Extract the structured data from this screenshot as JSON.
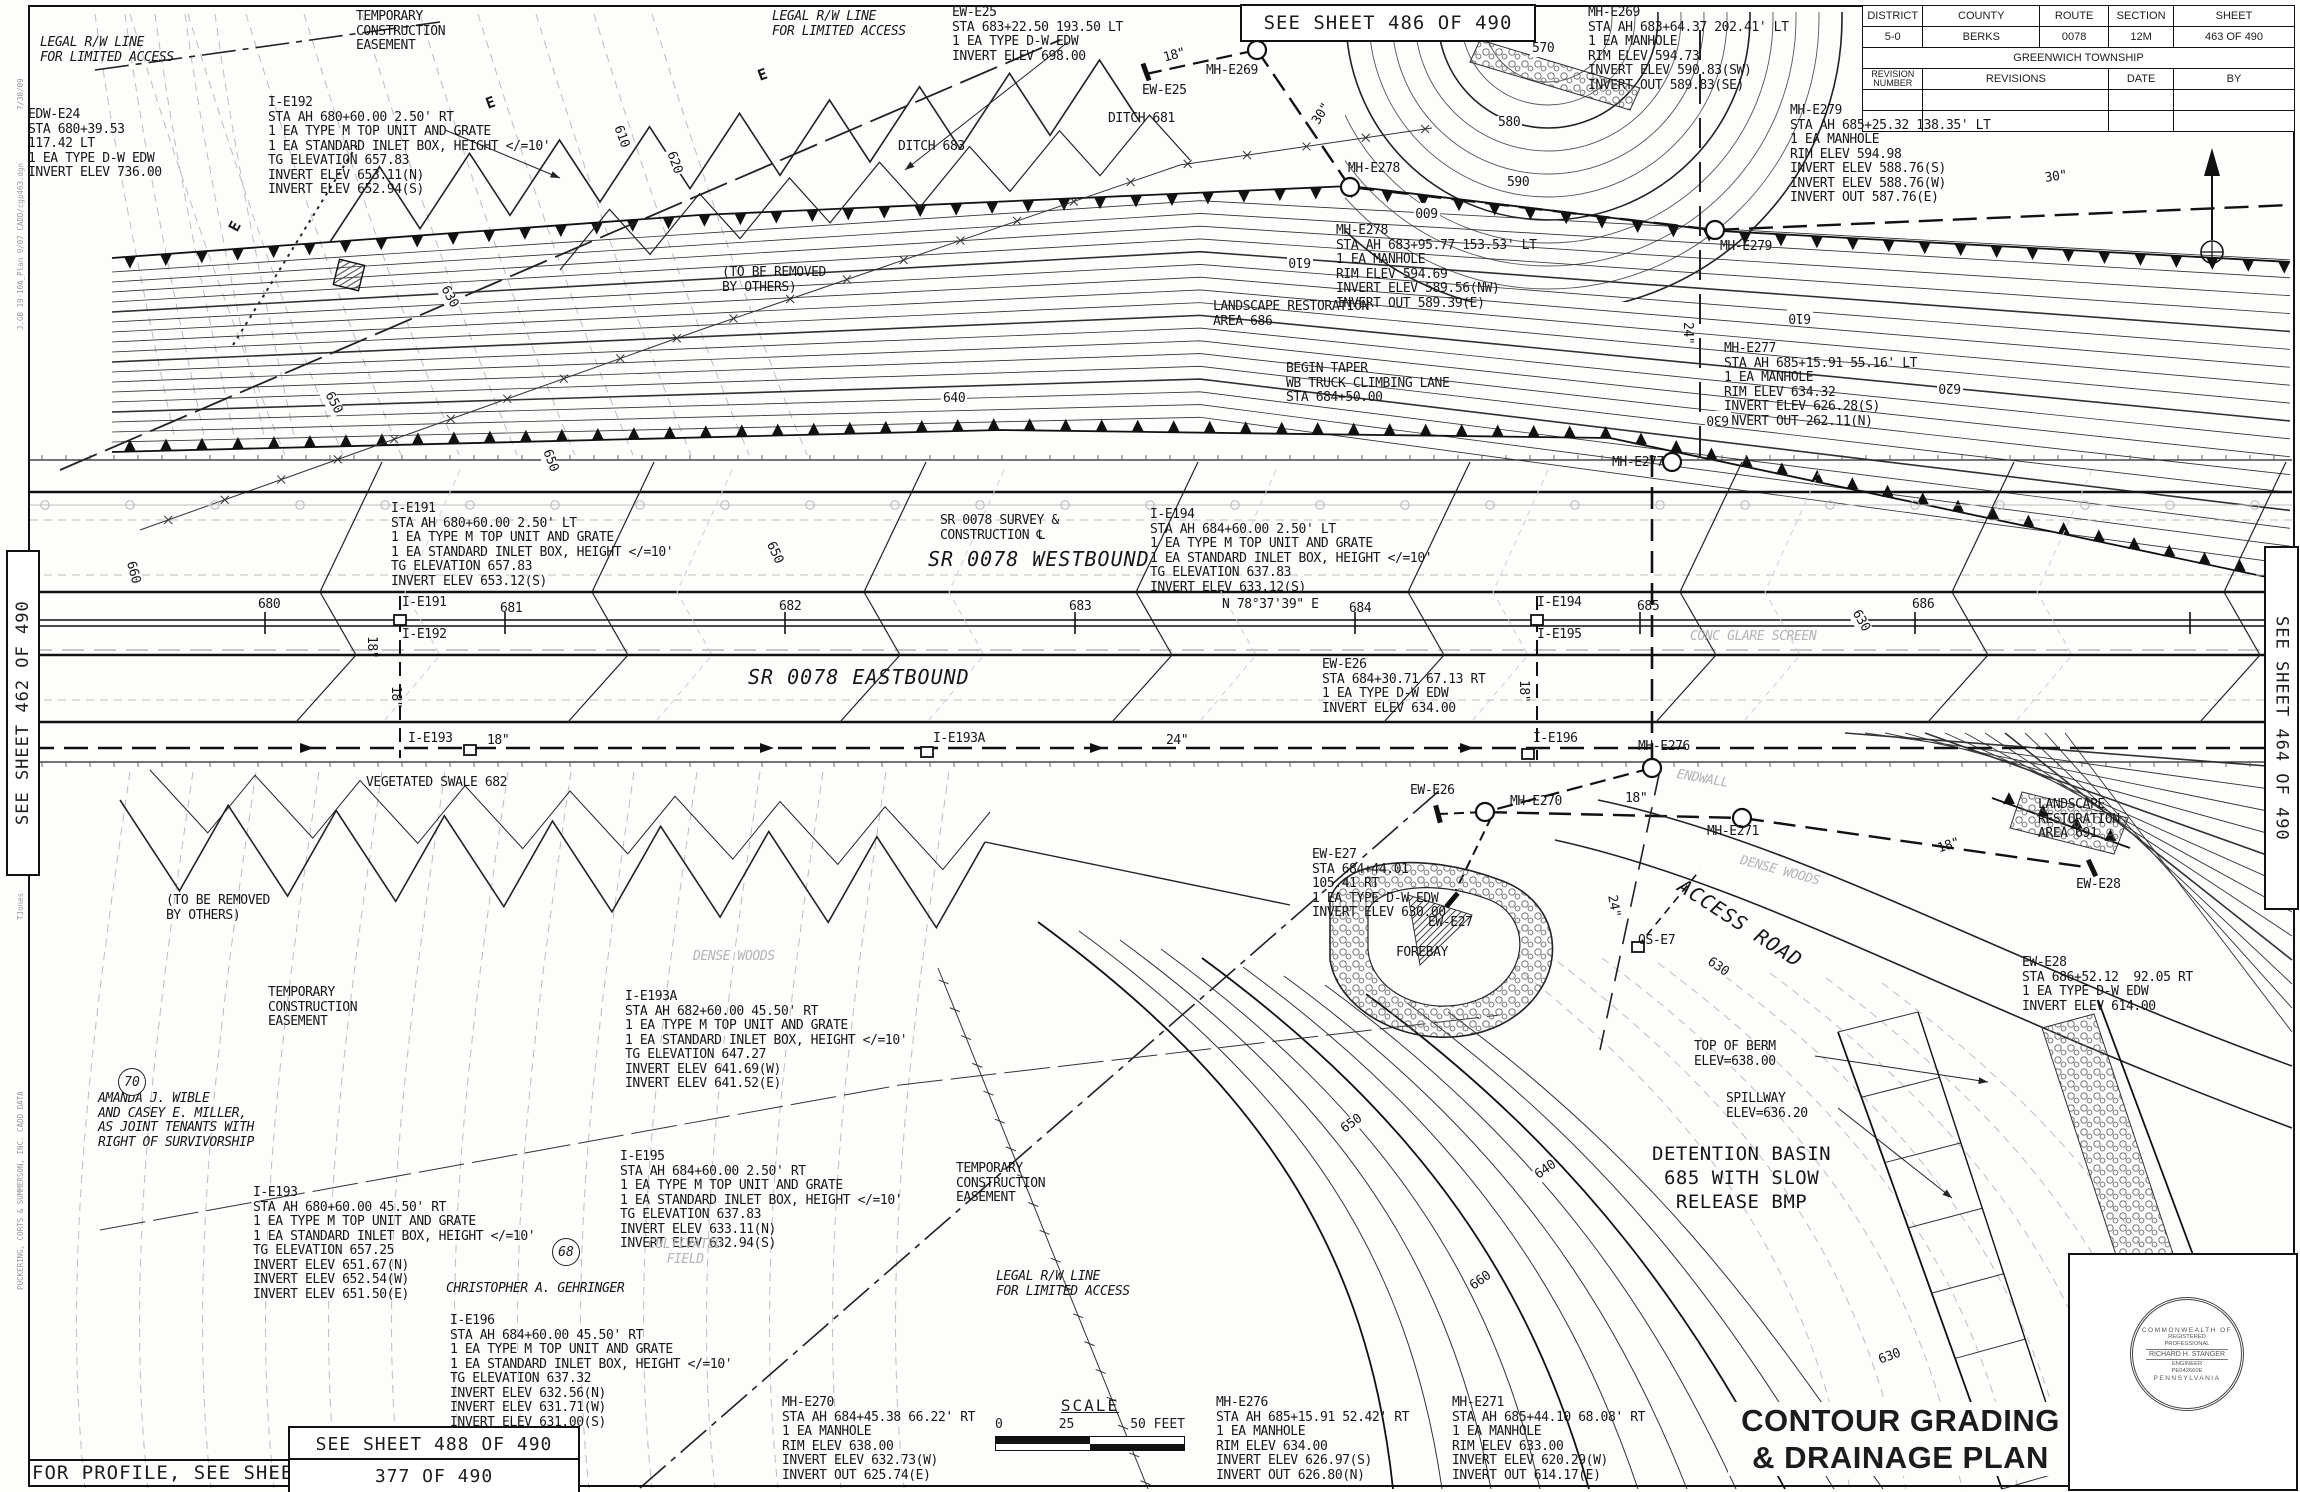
{
  "colors": {
    "ink": "#1c1c1c",
    "existing_gray": "#b5b5b5",
    "accent": "#111111"
  },
  "sheet_refs": {
    "top": "SEE SHEET 486 OF 490",
    "left": "SEE SHEET 462 OF 490",
    "right": "SEE SHEET 464 OF 490",
    "bottom": "SEE SHEET 488 OF 490",
    "profile_label": "FOR PROFILE, SEE SHEET",
    "profile_sheet": "377 OF 490"
  },
  "title_block": {
    "headers": [
      "DISTRICT",
      "COUNTY",
      "ROUTE",
      "SECTION",
      "SHEET"
    ],
    "values": [
      "5-0",
      "BERKS",
      "0078",
      "12M",
      "463 OF 490"
    ],
    "township": "GREENWICH TOWNSHIP",
    "rev_headers": [
      "REVISION NUMBER",
      "REVISIONS",
      "DATE",
      "BY"
    ]
  },
  "drawing_title": {
    "line1": "CONTOUR GRADING",
    "line2": "& DRAINAGE PLAN"
  },
  "scale_bar": {
    "label": "SCALE",
    "ticks": [
      "0",
      "25",
      "50 FEET"
    ]
  },
  "seal": {
    "arc_top": "COMMONWEALTH OF",
    "line1": "REGISTERED",
    "line2": "PROFESSIONAL",
    "name": "RICHARD H. STANGER",
    "line3": "ENGINEER",
    "line4": "PE042660E",
    "arc_bottom": "PENNSYLVANIA"
  },
  "annotations": [
    {
      "x": 40,
      "y": 36,
      "cls": "i",
      "lines": [
        "LEGAL R/W LINE",
        "FOR LIMITED ACCESS"
      ]
    },
    {
      "x": 356,
      "y": 10,
      "lines": [
        "TEMPORARY",
        "CONSTRUCTION",
        "EASEMENT"
      ]
    },
    {
      "x": 28,
      "y": 108,
      "lines": [
        "EDW-E24",
        "STA 680+39.53",
        "117.42 LT",
        "1 EA TYPE D-W EDW",
        "INVERT ELEV 736.00"
      ]
    },
    {
      "x": 268,
      "y": 96,
      "lines": [
        "I-E192",
        "STA AH 680+60.00 2.50' RT",
        "1 EA TYPE M TOP UNIT AND GRATE",
        "1 EA STANDARD INLET BOX, HEIGHT </=10'",
        "TG ELEVATION 657.83",
        "INVERT ELEV 653.11(N)",
        "INVERT ELEV 652.94(S)"
      ]
    },
    {
      "x": 772,
      "y": 10,
      "cls": "i",
      "lines": [
        "LEGAL R/W LINE",
        "FOR LIMITED ACCESS"
      ]
    },
    {
      "x": 952,
      "y": 6,
      "lines": [
        "EW-E25",
        "STA 683+22.50 193.50 LT",
        "1 EA TYPE D-W EDW",
        "INVERT ELEV 698.00"
      ]
    },
    {
      "x": 1162,
      "y": 52,
      "r": -15,
      "lines": [
        "18\""
      ]
    },
    {
      "x": 1206,
      "y": 64,
      "lines": [
        "MH-E269"
      ]
    },
    {
      "x": 1142,
      "y": 84,
      "lines": [
        "EW-E25"
      ]
    },
    {
      "x": 1108,
      "y": 112,
      "lines": [
        "DITCH 681"
      ]
    },
    {
      "x": 898,
      "y": 140,
      "lines": [
        "DITCH 683"
      ]
    },
    {
      "x": 1588,
      "y": 6,
      "lines": [
        "MH-E269",
        "STA AH 683+64.37 202.41' LT",
        "1 EA MANHOLE",
        "RIM ELEV 594.73",
        "INVERT ELEV 590.83(SW)",
        "INVERT OUT 589.83(SE)"
      ]
    },
    {
      "x": 1310,
      "y": 120,
      "r": -58,
      "lines": [
        "30\""
      ]
    },
    {
      "x": 1348,
      "y": 162,
      "lines": [
        "MH-E278"
      ]
    },
    {
      "x": 1336,
      "y": 224,
      "lines": [
        "MH-E278",
        "STA AH 683+95.77 153.53' LT",
        "1 EA MANHOLE",
        "RIM ELEV 594.69",
        "INVERT ELEV 589.56(NW)",
        "INVERT OUT 589.39(E)"
      ]
    },
    {
      "x": 1790,
      "y": 104,
      "lines": [
        "MH-E279",
        "STA AH 685+25.32 138.35' LT",
        "1 EA MANHOLE",
        "RIM ELEV 594.98",
        "INVERT ELEV 588.76(S)",
        "INVERT ELEV 588.76(W)",
        "INVERT OUT 587.76(E)"
      ]
    },
    {
      "x": 2044,
      "y": 172,
      "r": -8,
      "lines": [
        "30\""
      ]
    },
    {
      "x": 1720,
      "y": 240,
      "lines": [
        "MH-E279"
      ]
    },
    {
      "x": 1213,
      "y": 300,
      "lines": [
        "LANDSCAPE RESTORATION",
        "AREA 686"
      ]
    },
    {
      "x": 722,
      "y": 266,
      "lines": [
        "(TO BE REMOVED",
        "BY OTHERS)"
      ]
    },
    {
      "x": 1286,
      "y": 362,
      "lines": [
        "BEGIN TAPER",
        "WB TRUCK CLIMBING LANE",
        "STA 684+50.00"
      ]
    },
    {
      "x": 1724,
      "y": 342,
      "lines": [
        "MH-E277",
        "STA AH 685+15.91 55.16' LT",
        "1 EA MANHOLE",
        "RIM ELEV 634.32",
        "INVERT ELEV 626.28(S)",
        "INVERT OUT 262.11(N)"
      ]
    },
    {
      "x": 1694,
      "y": 322,
      "r": 90,
      "lines": [
        "24\""
      ]
    },
    {
      "x": 1612,
      "y": 456,
      "lines": [
        "MH-E277"
      ]
    },
    {
      "x": 391,
      "y": 502,
      "lines": [
        "I-E191",
        "STA AH 680+60.00 2.50' LT",
        "1 EA TYPE M TOP UNIT AND GRATE",
        "1 EA STANDARD INLET BOX, HEIGHT </=10'",
        "TG ELEVATION 657.83",
        "INVERT ELEV 653.12(S)"
      ]
    },
    {
      "x": 940,
      "y": 514,
      "lines": [
        "SR 0078 SURVEY &",
        "CONSTRUCTION ℄"
      ]
    },
    {
      "x": 928,
      "y": 552,
      "cls": "rd",
      "lines": [
        "SR 0078 WESTBOUND"
      ]
    },
    {
      "x": 1150,
      "y": 508,
      "lines": [
        "I-E194",
        "STA AH 684+60.00 2.50' LT",
        "1 EA TYPE M TOP UNIT AND GRATE",
        "1 EA STANDARD INLET BOX, HEIGHT </=10'",
        "TG ELEVATION 637.83",
        "INVERT ELEV 633.12(S)"
      ]
    },
    {
      "x": 258,
      "y": 598,
      "lines": [
        "680"
      ]
    },
    {
      "x": 500,
      "y": 602,
      "lines": [
        "681"
      ]
    },
    {
      "x": 779,
      "y": 600,
      "lines": [
        "682"
      ]
    },
    {
      "x": 1069,
      "y": 600,
      "lines": [
        "683"
      ]
    },
    {
      "x": 1222,
      "y": 598,
      "lines": [
        "N 78°37'39\" E"
      ]
    },
    {
      "x": 1349,
      "y": 602,
      "lines": [
        "684"
      ]
    },
    {
      "x": 1637,
      "y": 600,
      "lines": [
        "685"
      ]
    },
    {
      "x": 1912,
      "y": 598,
      "lines": [
        "686"
      ]
    },
    {
      "x": 402,
      "y": 596,
      "lines": [
        "I-E191"
      ]
    },
    {
      "x": 402,
      "y": 628,
      "lines": [
        "I-E192"
      ]
    },
    {
      "x": 1537,
      "y": 596,
      "lines": [
        "I-E194"
      ]
    },
    {
      "x": 1537,
      "y": 628,
      "lines": [
        "I-E195"
      ]
    },
    {
      "x": 378,
      "y": 636,
      "r": 90,
      "lines": [
        "18\""
      ]
    },
    {
      "x": 402,
      "y": 686,
      "r": 90,
      "lines": [
        "18\""
      ]
    },
    {
      "x": 1530,
      "y": 680,
      "r": 90,
      "lines": [
        "18\""
      ]
    },
    {
      "x": 748,
      "y": 670,
      "cls": "rd",
      "lines": [
        "SR 0078 EASTBOUND"
      ]
    },
    {
      "x": 1322,
      "y": 658,
      "lines": [
        "EW-E26",
        "STA 684+30.71 67.13 RT",
        "1 EA TYPE D-W EDW",
        "INVERT ELEV 634.00"
      ]
    },
    {
      "x": 408,
      "y": 732,
      "lines": [
        "I-E193"
      ]
    },
    {
      "x": 487,
      "y": 734,
      "lines": [
        "18\""
      ]
    },
    {
      "x": 933,
      "y": 732,
      "lines": [
        "I-E193A"
      ]
    },
    {
      "x": 1166,
      "y": 734,
      "lines": [
        "24\""
      ]
    },
    {
      "x": 1533,
      "y": 732,
      "lines": [
        "I-E196"
      ]
    },
    {
      "x": 1638,
      "y": 740,
      "lines": [
        "MH-E276"
      ]
    },
    {
      "x": 366,
      "y": 776,
      "lines": [
        "VEGETATED SWALE 682"
      ]
    },
    {
      "x": 1690,
      "y": 630,
      "cls": "gi",
      "lines": [
        "CONC GLARE SCREEN"
      ]
    },
    {
      "x": 1410,
      "y": 784,
      "lines": [
        "EW-E26"
      ]
    },
    {
      "x": 1510,
      "y": 795,
      "lines": [
        "MH-E270"
      ]
    },
    {
      "x": 1625,
      "y": 792,
      "lines": [
        "18\""
      ]
    },
    {
      "x": 1707,
      "y": 825,
      "lines": [
        "MH-E271"
      ]
    },
    {
      "x": 1678,
      "y": 768,
      "cls": "gi",
      "r": 10,
      "lines": [
        "ENDWALL"
      ]
    },
    {
      "x": 1684,
      "y": 878,
      "cls": "rd",
      "r": 33,
      "lines": [
        "ACCESS ROAD"
      ]
    },
    {
      "x": 1742,
      "y": 854,
      "cls": "gi",
      "r": 15,
      "lines": [
        "DENSE WOODS"
      ]
    },
    {
      "x": 1638,
      "y": 934,
      "lines": [
        "OS-E7"
      ]
    },
    {
      "x": 1618,
      "y": 894,
      "r": 80,
      "lines": [
        "24\""
      ]
    },
    {
      "x": 1312,
      "y": 848,
      "lines": [
        "EW-E27",
        "STA 684+44.01",
        "105.41 RT",
        "1 EA TYPE D-W EDW",
        "INVERT ELEV 630.00"
      ]
    },
    {
      "x": 1428,
      "y": 916,
      "lines": [
        "EW-E27"
      ]
    },
    {
      "x": 1396,
      "y": 946,
      "lines": [
        "FOREBAY"
      ]
    },
    {
      "x": 166,
      "y": 894,
      "lines": [
        "(TO BE REMOVED",
        "BY OTHERS)"
      ]
    },
    {
      "x": 268,
      "y": 986,
      "lines": [
        "TEMPORARY",
        "CONSTRUCTION",
        "EASEMENT"
      ]
    },
    {
      "x": 693,
      "y": 950,
      "cls": "gi",
      "lines": [
        "DENSE WOODS"
      ]
    },
    {
      "x": 625,
      "y": 990,
      "lines": [
        "I-E193A",
        "STA AH 682+60.00 45.50' RT",
        "1 EA TYPE M TOP UNIT AND GRATE",
        "1 EA STANDARD INLET BOX, HEIGHT </=10'",
        "TG ELEVATION 647.27",
        "INVERT ELEV 641.69(W)",
        "INVERT ELEV 641.52(E)"
      ]
    },
    {
      "x": 98,
      "y": 1092,
      "cls": "i",
      "lines": [
        "AMANDA J. WIBLE",
        "AND CASEY E. MILLER,",
        "AS JOINT TENANTS WITH",
        "RIGHT OF SURVIVORSHIP"
      ]
    },
    {
      "x": 620,
      "y": 1150,
      "lines": [
        "I-E195",
        "STA AH 684+60.00 2.50' RT",
        "1 EA TYPE M TOP UNIT AND GRATE",
        "1 EA STANDARD INLET BOX, HEIGHT </=10'",
        "TG ELEVATION 637.83",
        "INVERT ELEV 633.11(N)",
        "INVERT ELEV 632.94(S)"
      ]
    },
    {
      "x": 253,
      "y": 1186,
      "lines": [
        "I-E193",
        "STA AH 680+60.00 45.50' RT",
        "1 EA TYPE M TOP UNIT AND GRATE",
        "1 EA STANDARD INLET BOX, HEIGHT </=10'",
        "TG ELEVATION 657.25",
        "INVERT ELEV 651.67(N)",
        "INVERT ELEV 652.54(W)",
        "INVERT ELEV 651.50(E)"
      ]
    },
    {
      "x": 446,
      "y": 1282,
      "cls": "i",
      "lines": [
        "CHRISTOPHER A. GEHRINGER"
      ]
    },
    {
      "x": 648,
      "y": 1238,
      "cls": "gi ctr",
      "lines": [
        "CULTIVATED",
        "FIELD"
      ]
    },
    {
      "x": 450,
      "y": 1314,
      "lines": [
        "I-E196",
        "STA AH 684+60.00 45.50' RT",
        "1 EA TYPE M TOP UNIT AND GRATE",
        "1 EA STANDARD INLET BOX, HEIGHT </=10'",
        "TG ELEVATION 637.32",
        "INVERT ELEV 632.56(N)",
        "INVERT ELEV 631.71(W)",
        "INVERT ELEV 631.00(S)"
      ]
    },
    {
      "x": 956,
      "y": 1162,
      "lines": [
        "TEMPORARY",
        "CONSTRUCTION",
        "EASEMENT"
      ]
    },
    {
      "x": 996,
      "y": 1270,
      "cls": "i",
      "lines": [
        "LEGAL R/W LINE",
        "FOR LIMITED ACCESS"
      ]
    },
    {
      "x": 1694,
      "y": 1040,
      "lines": [
        "TOP OF BERM",
        "ELEV=638.00"
      ]
    },
    {
      "x": 1726,
      "y": 1092,
      "lines": [
        "SPILLWAY",
        "ELEV=636.20"
      ]
    },
    {
      "x": 1652,
      "y": 1142,
      "cls": "bas",
      "lines": [
        "DETENTION BASIN",
        "685 WITH SLOW",
        "RELEASE BMP"
      ]
    },
    {
      "x": 2022,
      "y": 956,
      "lines": [
        "EW-E28",
        "STA 686+52.12  92.05 RT",
        "1 EA TYPE D-W EDW",
        "INVERT ELEV 614.00"
      ]
    },
    {
      "x": 2038,
      "y": 798,
      "lines": [
        "LANDSCAPE",
        "RESTORATION",
        "AREA 691"
      ]
    },
    {
      "x": 2076,
      "y": 878,
      "lines": [
        "EW-E28"
      ]
    },
    {
      "x": 1936,
      "y": 843,
      "r": -18,
      "lines": [
        "18\""
      ]
    },
    {
      "x": 782,
      "y": 1396,
      "lines": [
        "MH-E270",
        "STA AH 684+45.38 66.22' RT",
        "1 EA MANHOLE",
        "RIM ELEV 638.00",
        "INVERT ELEV 632.73(W)",
        "INVERT OUT 625.74(E)"
      ]
    },
    {
      "x": 1216,
      "y": 1396,
      "lines": [
        "MH-E276",
        "STA AH 685+15.91 52.42' RT",
        "1 EA MANHOLE",
        "RIM ELEV 634.00",
        "INVERT ELEV 626.97(S)",
        "INVERT OUT 626.80(N)"
      ]
    },
    {
      "x": 1452,
      "y": 1396,
      "lines": [
        "MH-E271",
        "STA AH 685+44.10 68.08' RT",
        "1 EA MANHOLE",
        "RIM ELEV 633.00",
        "INVERT ELEV 620.29(W)",
        "INVERT OUT 614.17(E)"
      ]
    },
    {
      "x": 1530,
      "y": 42,
      "cls": "ct",
      "lines": [
        "570"
      ]
    },
    {
      "x": 1496,
      "y": 116,
      "cls": "ct",
      "lines": [
        "580"
      ]
    },
    {
      "x": 1505,
      "y": 176,
      "cls": "ct",
      "lines": [
        "590"
      ]
    },
    {
      "x": 1440,
      "y": 218,
      "cls": "ct",
      "r": 180,
      "lines": [
        "600"
      ]
    },
    {
      "x": 1313,
      "y": 268,
      "cls": "ct",
      "r": 180,
      "lines": [
        "610"
      ]
    },
    {
      "x": 1813,
      "y": 324,
      "cls": "ct",
      "r": 180,
      "lines": [
        "610"
      ]
    },
    {
      "x": 1963,
      "y": 394,
      "cls": "ct",
      "r": 180,
      "lines": [
        "620"
      ]
    },
    {
      "x": 1731,
      "y": 426,
      "cls": "ct",
      "r": 180,
      "lines": [
        "630"
      ]
    },
    {
      "x": 941,
      "y": 392,
      "cls": "ct",
      "lines": [
        "640"
      ]
    },
    {
      "x": 623,
      "y": 122,
      "cls": "ct",
      "r": 70,
      "lines": [
        "610"
      ]
    },
    {
      "x": 676,
      "y": 148,
      "cls": "ct",
      "r": 70,
      "lines": [
        "620"
      ]
    },
    {
      "x": 449,
      "y": 282,
      "cls": "ct",
      "r": 62,
      "lines": [
        "630"
      ]
    },
    {
      "x": 333,
      "y": 388,
      "cls": "ct",
      "r": 62,
      "lines": [
        "650"
      ]
    },
    {
      "x": 136,
      "y": 558,
      "cls": "ct",
      "r": 75,
      "lines": [
        "660"
      ]
    },
    {
      "x": 552,
      "y": 446,
      "cls": "ct",
      "r": 70,
      "lines": [
        "650"
      ]
    },
    {
      "x": 775,
      "y": 538,
      "cls": "ct",
      "r": 65,
      "lines": [
        "650"
      ]
    },
    {
      "x": 1860,
      "y": 606,
      "cls": "ct",
      "r": 60,
      "lines": [
        "630"
      ]
    },
    {
      "x": 1711,
      "y": 954,
      "cls": "ct",
      "r": 35,
      "lines": [
        "630"
      ]
    },
    {
      "x": 1337,
      "y": 1126,
      "cls": "ct",
      "r": -35,
      "lines": [
        "650"
      ]
    },
    {
      "x": 1531,
      "y": 1172,
      "cls": "ct",
      "r": -35,
      "lines": [
        "640"
      ]
    },
    {
      "x": 1466,
      "y": 1283,
      "cls": "ct",
      "r": -35,
      "lines": [
        "660"
      ]
    },
    {
      "x": 1875,
      "y": 1355,
      "cls": "ct",
      "r": -20,
      "lines": [
        "630"
      ]
    },
    {
      "x": 483,
      "y": 98,
      "cls": "e",
      "r": -20,
      "lines": [
        "E"
      ]
    },
    {
      "x": 755,
      "y": 70,
      "cls": "e",
      "r": -20,
      "lines": [
        "E"
      ]
    },
    {
      "x": 226,
      "y": 228,
      "cls": "e",
      "r": -62,
      "lines": [
        "E"
      ]
    },
    {
      "x": 14,
      "y": 110,
      "cls": "tiny",
      "r": -90,
      "lines": [
        "7/30/09"
      ]
    },
    {
      "x": 14,
      "y": 330,
      "cls": "tiny",
      "r": -90,
      "lines": [
        "J.GB 19-10A_Plan 9/07 CADD/cgp463.dgn"
      ]
    },
    {
      "x": 14,
      "y": 920,
      "cls": "tiny",
      "r": -90,
      "lines": [
        "TJones"
      ]
    },
    {
      "x": 14,
      "y": 1290,
      "cls": "tiny",
      "r": -90,
      "lines": [
        "PUCKERING, CORTS & SUMMERSON, INC. CADD DATA"
      ]
    }
  ],
  "parcels": [
    {
      "x": 118,
      "y": 1068,
      "label": "70"
    },
    {
      "x": 552,
      "y": 1238,
      "label": "68"
    }
  ]
}
